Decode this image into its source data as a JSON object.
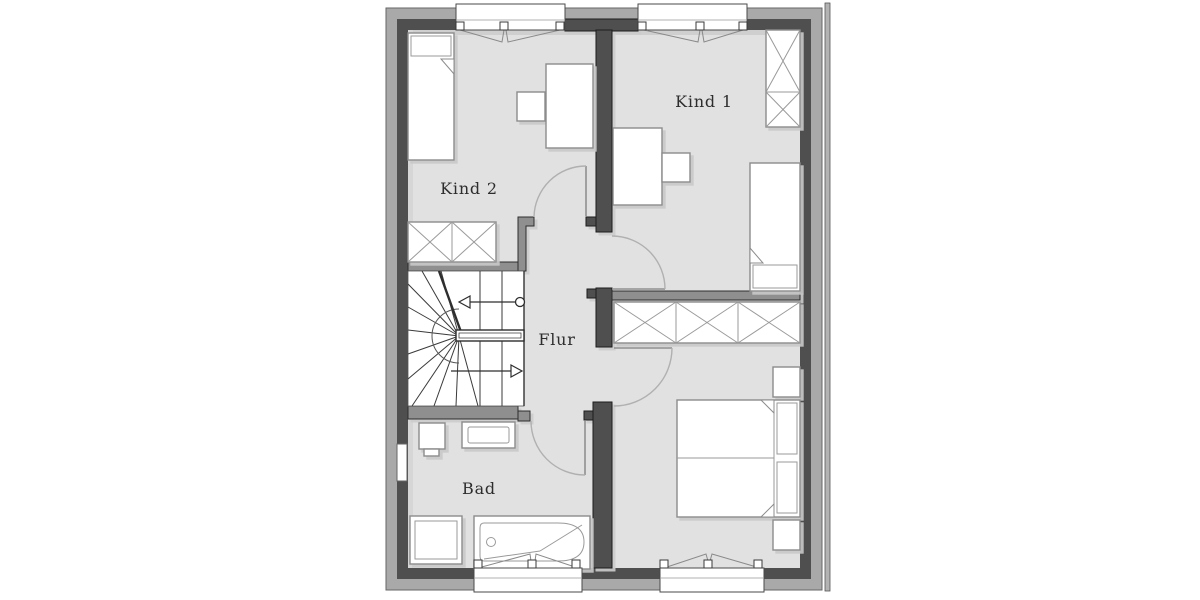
{
  "floorplan": {
    "title": "Obergeschoss Grundriss",
    "rooms": [
      {
        "id": "kind1",
        "label": "Kind 1"
      },
      {
        "id": "kind2",
        "label": "Kind 2"
      },
      {
        "id": "flur",
        "label": "Flur"
      },
      {
        "id": "bad",
        "label": "Bad"
      }
    ],
    "colors": {
      "background": "#ffffff",
      "floor": "#e1e1e1",
      "outer_wall_band": "#a9a9a9",
      "inner_wall": "#4f4f4f",
      "partition_wall": "#8f8f8f",
      "furniture_fill": "#ffffff",
      "furniture_stroke": "#8c8c8c",
      "shadow": "#c8c8c8",
      "door_arc": "#b0b0b0"
    }
  }
}
